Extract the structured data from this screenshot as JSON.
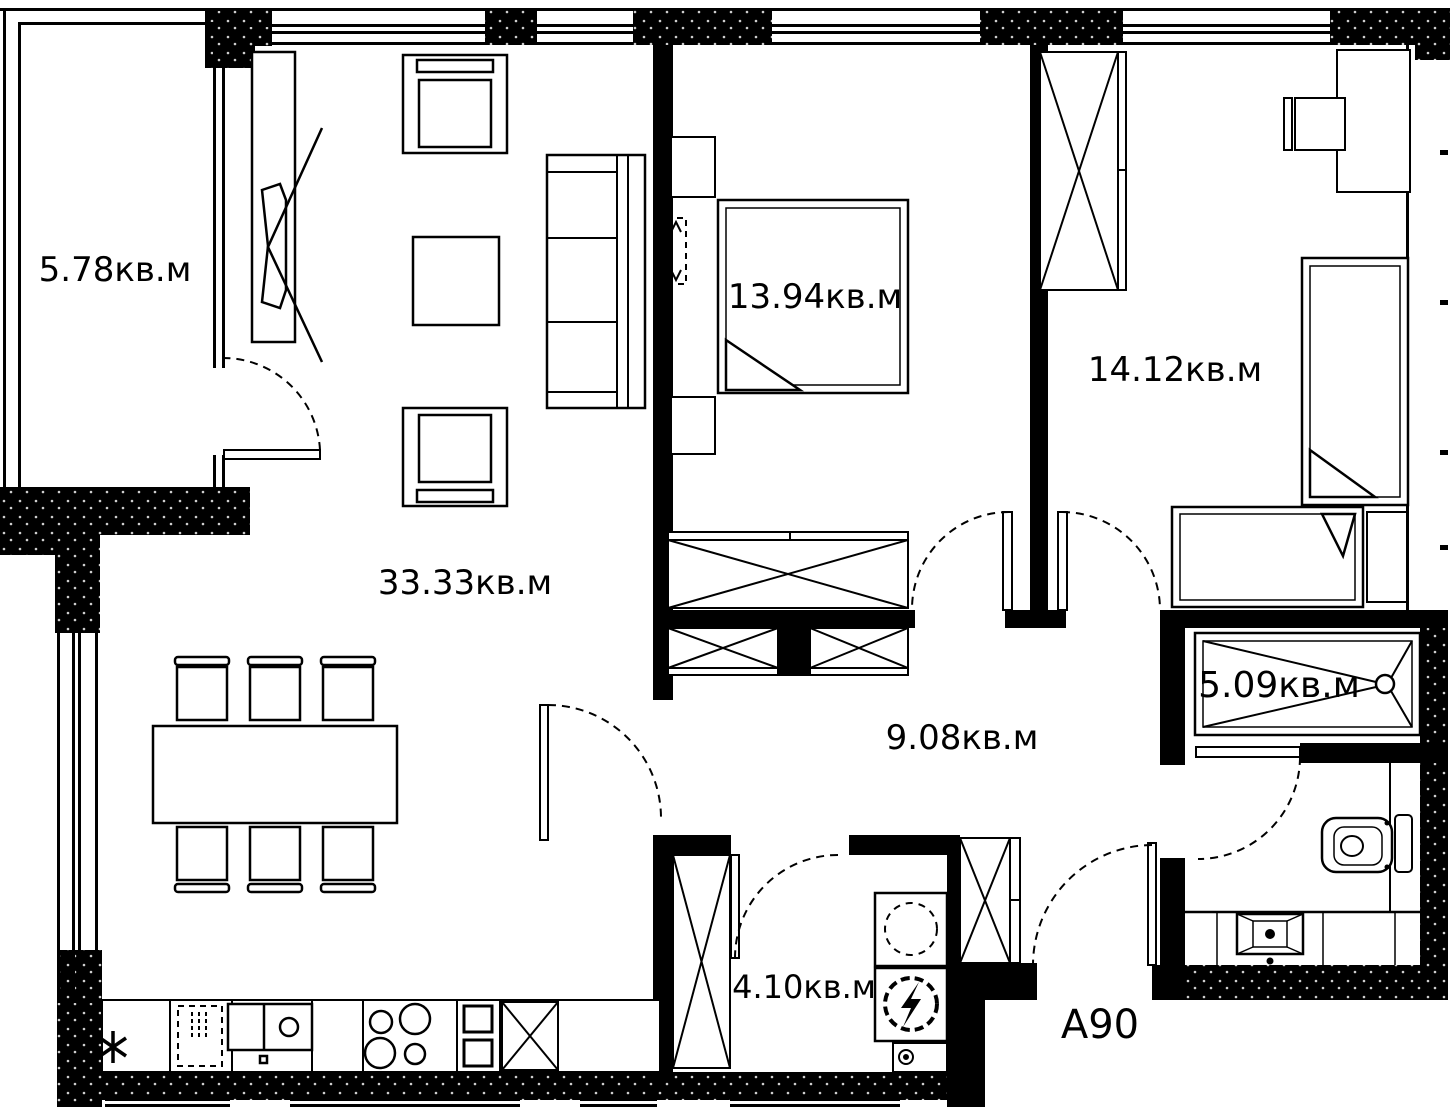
{
  "plan": {
    "unit_label": "A90",
    "rooms": [
      {
        "name": "balcony",
        "area_label": "5.78кв.м"
      },
      {
        "name": "living-room",
        "area_label": "33.33кв.м"
      },
      {
        "name": "bedroom-1",
        "area_label": "13.94кв.м"
      },
      {
        "name": "bedroom-2",
        "area_label": "14.12кв.м"
      },
      {
        "name": "hallway",
        "area_label": "9.08кв.м"
      },
      {
        "name": "bathroom",
        "area_label": "5.09кв.м"
      },
      {
        "name": "laundry",
        "area_label": "4.10кв.м"
      }
    ],
    "colors": {
      "walls": "#000000",
      "background": "#ffffff"
    }
  }
}
